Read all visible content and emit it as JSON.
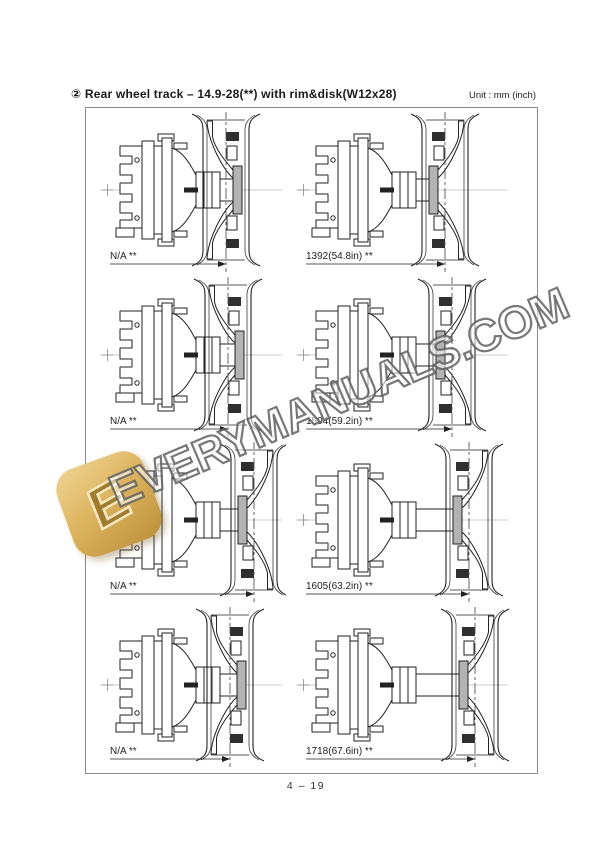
{
  "header": {
    "title": "② Rear wheel track – 14.9-28(**) with rim&disk(W12x28)",
    "unit": "Unit : mm (inch)"
  },
  "diagrams": [
    {
      "label": "N/A **"
    },
    {
      "label": "1392(54.8in) **"
    },
    {
      "label": "N/A **"
    },
    {
      "label": "1504(59.2in) **"
    },
    {
      "label": "N/A **"
    },
    {
      "label": "1605(63.2in) **"
    },
    {
      "label": "N/A **"
    },
    {
      "label": "1718(67.6in) **"
    }
  ],
  "watermark": {
    "text": "EVERYMANUALS.COM",
    "logo_letter": "E"
  },
  "footer": {
    "page": "4 – 19"
  }
}
